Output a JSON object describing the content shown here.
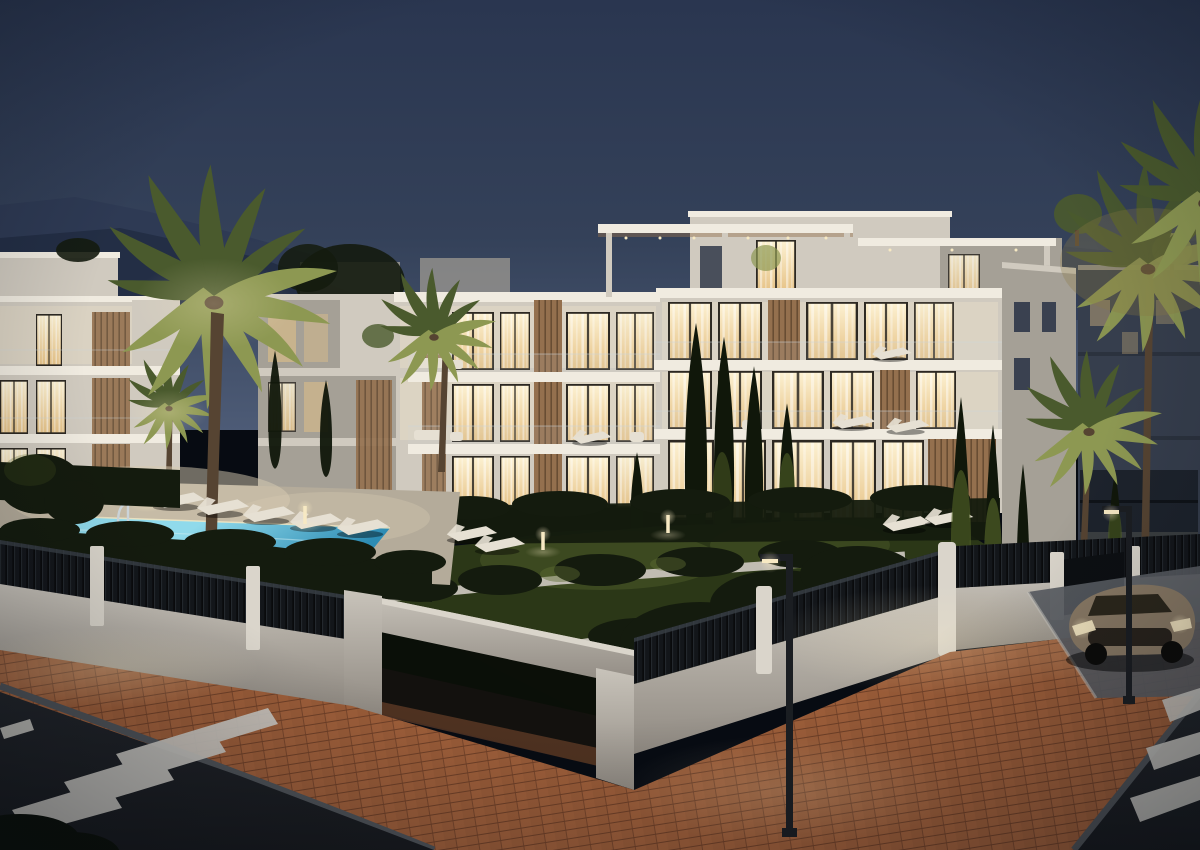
{
  "scene": {
    "type": "3d-architectural-render",
    "time_of_day": "dusk",
    "description": "Modern white low-rise apartment complex at dusk: warm-lit floor-to-ceiling windows with sheer curtains, wood-slat facade accents, glass balconies, rooftop pergola terraces with potted olive trees, illuminated turquoise swimming pool with sun loungers, landscaped gardens with palms, cypresses and hedges, white perimeter wall topped with black slatted fence, corner entrance portal, terracotta brick sidewalk, asphalt streets with zebra crosswalks, two street lamps and a parked bronze coupe; mountain silhouettes under a deep blue evening sky.",
    "objects": [
      "dusk-sky",
      "mountains",
      "main-apartment-building",
      "left-apartment-building",
      "background-building",
      "rooftop-pergolas",
      "glowing-windows",
      "balconies",
      "swimming-pool",
      "pool-ladders",
      "sun-loungers",
      "garden-lawn",
      "planters",
      "hedges",
      "palm-trees",
      "cypress-trees",
      "bollard-lights",
      "perimeter-wall",
      "slatted-fence",
      "entrance-portal",
      "brick-sidewalk",
      "asphalt-road",
      "zebra-crosswalk",
      "parking-bay",
      "parked-car",
      "street-lamps"
    ]
  },
  "palette": {
    "sky_top": "#2a3650",
    "sky_mid": "#344159",
    "sky_horizon": "#4d5b76",
    "mountain": "#232e45",
    "mountain_far": "#2e3a54",
    "white_lit": "#e8dec8",
    "white_mid": "#d0cabf",
    "white_dim": "#a5a096",
    "white_dark": "#7e7971",
    "roof_edge": "#f0ebe0",
    "window_bright": "#fdf2d3",
    "window_deep": "#e6c286",
    "window_frame": "#2c2822",
    "window_unlit": "#3a4150",
    "wood": "#94704e",
    "wood_dark": "#684d33",
    "glass_rail": "#ccd5da",
    "hedge": "#141b0e",
    "hedge_lit": "#46561f",
    "grass": "#2b3717",
    "grass_lit": "#5d6d32",
    "cypress": "#10170a",
    "cypress_lit": "#506026",
    "frond": "#4a5a2d",
    "frond_lit": "#8d9852",
    "frond_warm": "#8a7a44",
    "trunk": "#564432",
    "pool_bright": "#90daeb",
    "pool_deep": "#2d8cb4",
    "deck": "#b4ab9a",
    "deck_lit": "#d7cbb2",
    "lounger": "#e6e0d3",
    "wall": "#c8c3ba",
    "wall_dim": "#8f8981",
    "fence": "#13161a",
    "post": "#dad5cb",
    "asphalt": "#212429",
    "asphalt_dark": "#17191d",
    "curb": "#4e5257",
    "stripe": "#c9c7c1",
    "brick": "#9a5c38",
    "brick_lit": "#c78a50",
    "parking": "#595c62",
    "car_body": "#8a7a65",
    "car_glass": "#242015",
    "tire": "#0c0b09",
    "lamp_metal": "#1b1e22",
    "light": "#f7e9c3",
    "bg_build": "#363e4d",
    "vignette": "#060a11"
  }
}
